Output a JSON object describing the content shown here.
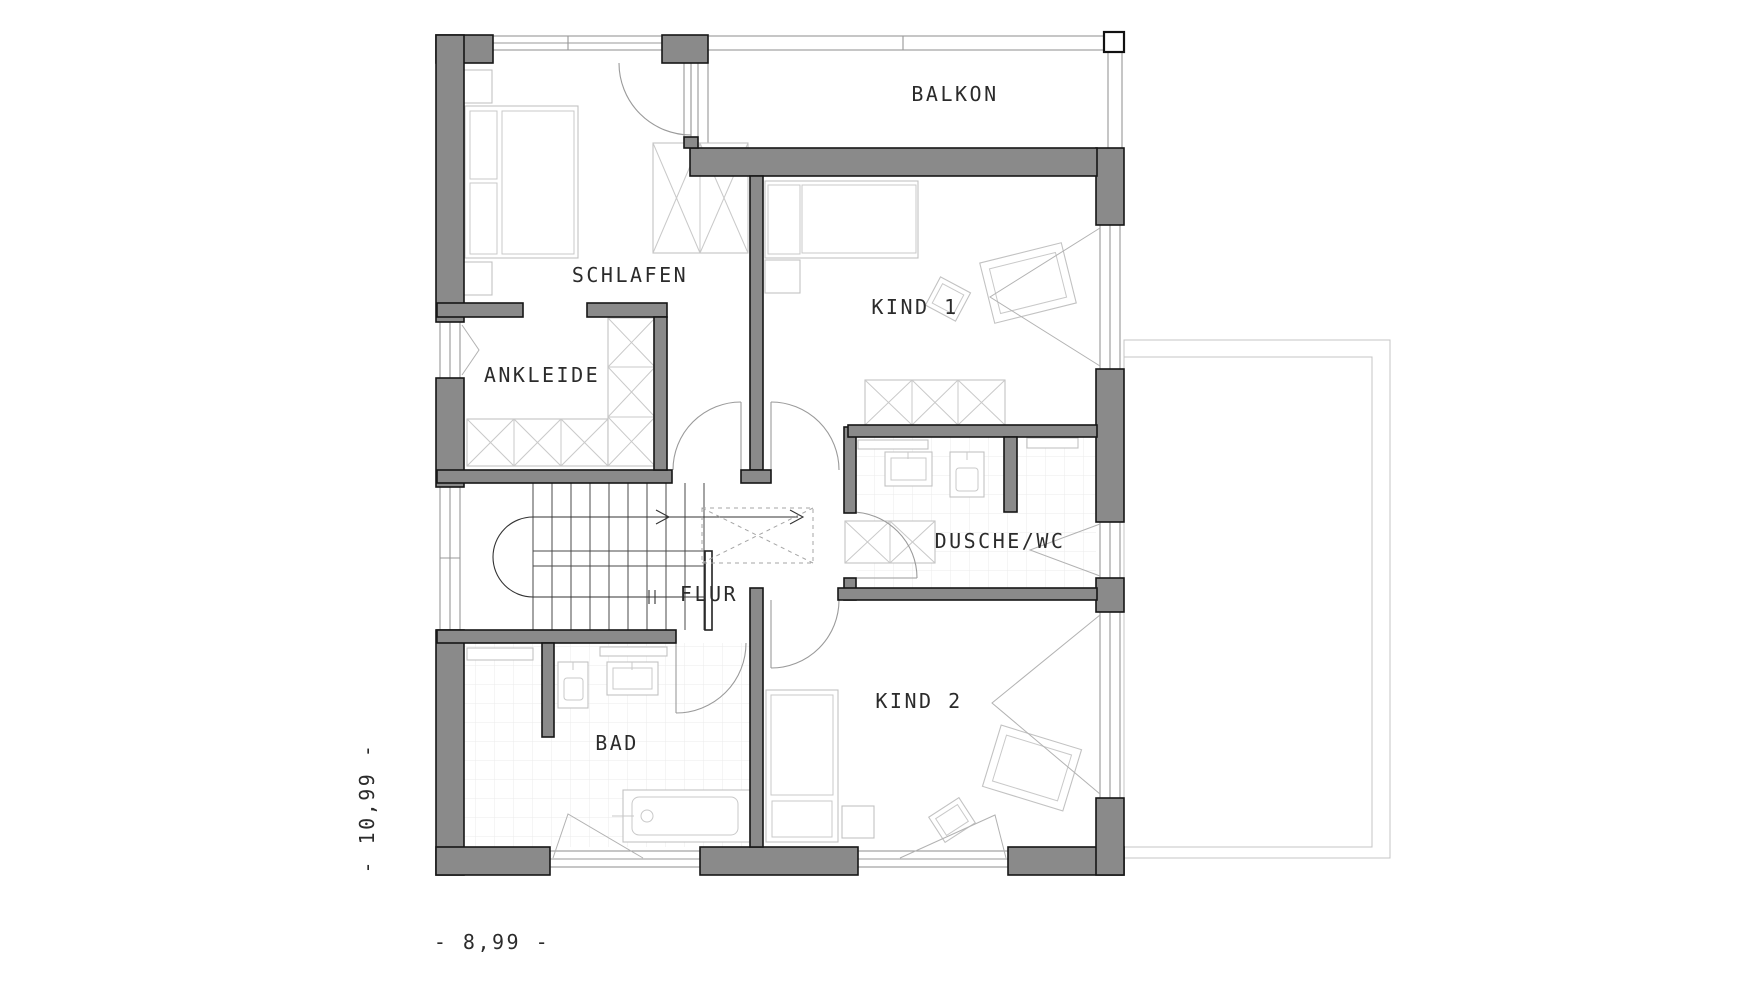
{
  "rooms": {
    "balkon": {
      "label": "BALKON"
    },
    "schlafen": {
      "label": "SCHLAFEN"
    },
    "kind1": {
      "label": "KIND 1"
    },
    "ankleide": {
      "label": "ANKLEIDE"
    },
    "dusche_wc": {
      "label": "DUSCHE/WC"
    },
    "flur": {
      "label": "FLUR"
    },
    "bad": {
      "label": "BAD"
    },
    "kind2": {
      "label": "KIND 2"
    }
  },
  "dimensions": {
    "height": "- 10,99 -",
    "width": "- 8,99 -"
  },
  "colors": {
    "wall_fill": "#8a8a8a",
    "wall_outline": "#161616",
    "drawing_line": "#989898",
    "furniture_line": "#c2c2c2",
    "tile_line": "#ebebeb",
    "text": "#2b2b2b",
    "background": "#ffffff"
  },
  "furniture_icons": [
    "double-bed-icon",
    "nightstand-icon",
    "wardrobe-icon",
    "single-bed-icon",
    "desk-icon",
    "chair-icon",
    "stairs-icon",
    "stairs-direction-arrow-icon",
    "skylight-dashed-icon",
    "washbasin-icon",
    "toilet-icon",
    "shower-icon",
    "bathtub-icon",
    "balcony-railing-icon",
    "terrace-outline-icon",
    "door-swing-icon",
    "window-icon"
  ]
}
